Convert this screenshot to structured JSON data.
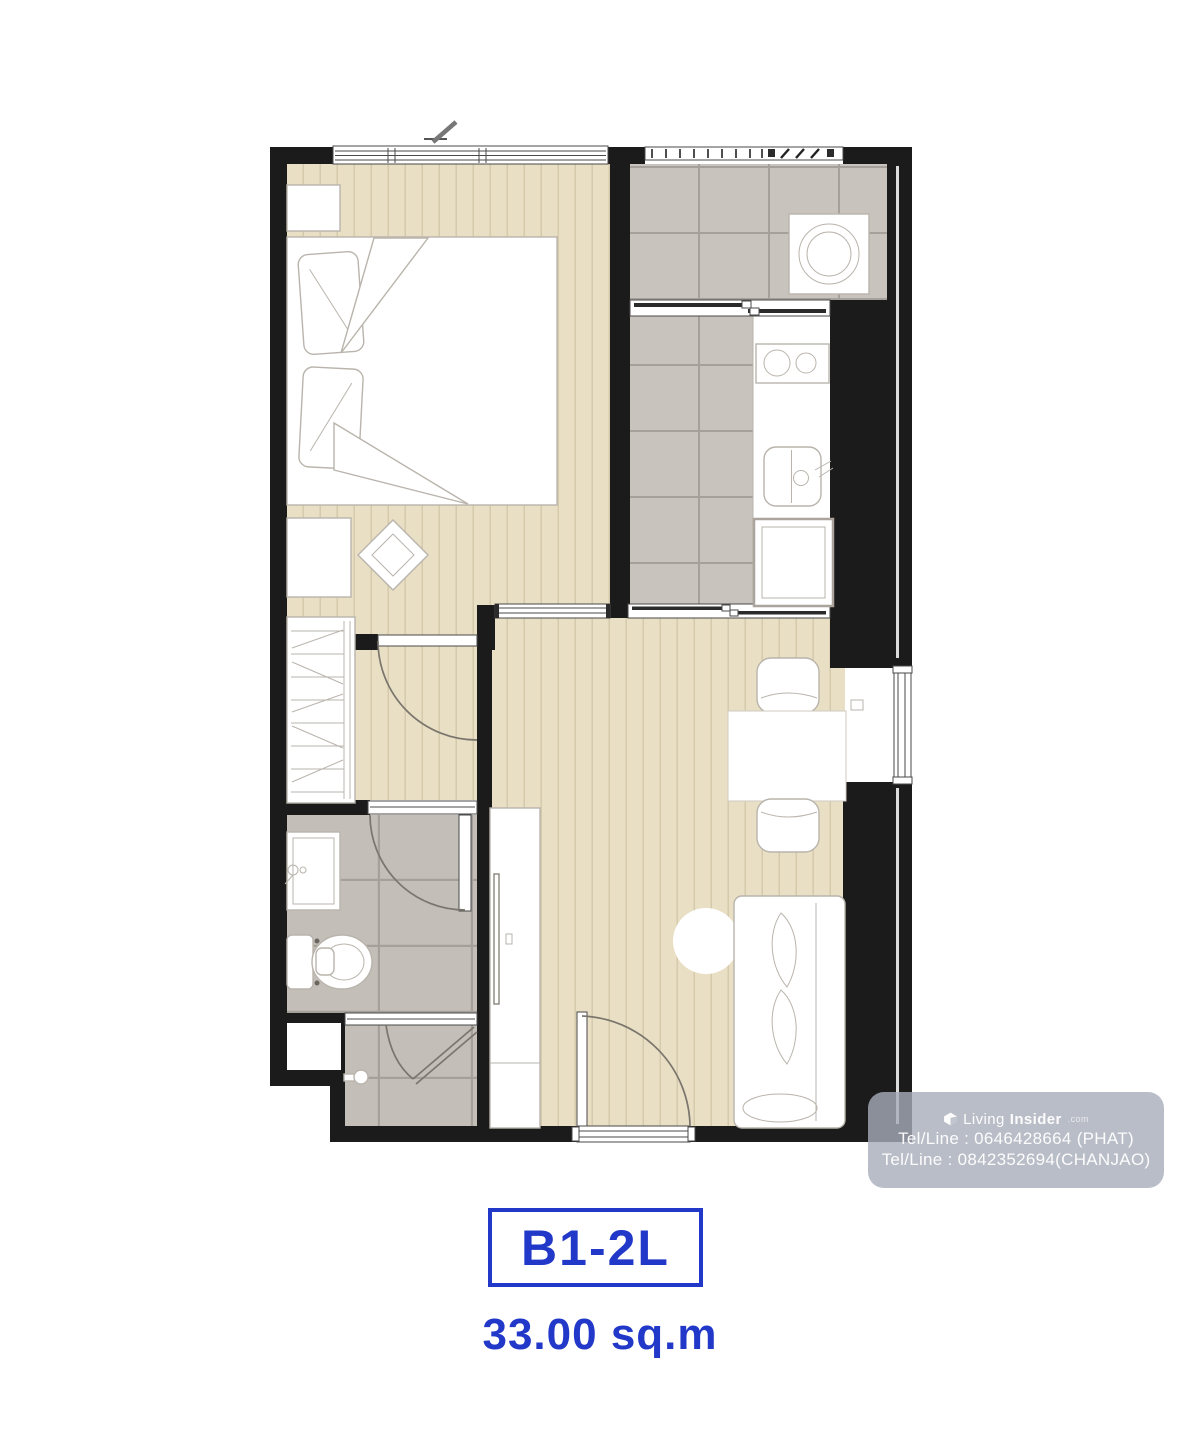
{
  "unit": {
    "code": "B1-2L",
    "area": "33.00 sq.m"
  },
  "watermark": {
    "brand_prefix": "Living",
    "brand_bold": "Insider",
    "brand_suffix": ".com",
    "tel_line_1": "Tel/Line : 0646428664 (PHAT)",
    "tel_line_2": "Tel/Line : 0842352694(CHANJAO)"
  },
  "colors": {
    "accent_blue": "#2138c8",
    "wall": "#1b1b1b",
    "wood_floor": "#e9dfc4",
    "wood_stripe": "#d3c7a7",
    "tile": "#c8c4bd",
    "tile_grout": "#a5a19a",
    "bath_tile": "#c3bfb8",
    "furniture_outline": "#b9b4ac",
    "watermark_bg": "#a7acb9",
    "watermark_text": "#ffffff"
  }
}
